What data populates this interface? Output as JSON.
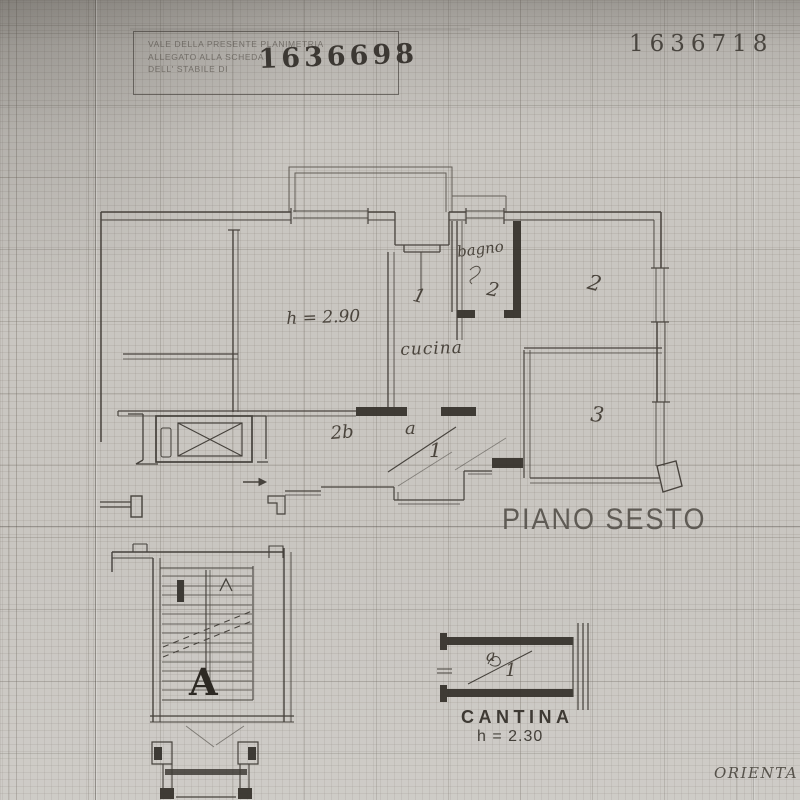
{
  "page": {
    "stamp_box": {
      "line1": "VALE DELLA PRESENTE PLANIMETRIA",
      "line2": "ALLEGATO ALLA SCHEDA",
      "line3": "DELL' STABILE DI",
      "number": "1636698"
    },
    "top_right_number": "1636718",
    "floor_label": "PIANO SESTO",
    "orientation_label": "ORIENTA",
    "cantina": {
      "title": "CANTINA",
      "height_note": "h = 2.30",
      "unit_top": "a",
      "unit_bottom": "1"
    },
    "annotations": {
      "ceiling_height": "h = 2.90",
      "kitchen": "cucina",
      "kitchen_number": "1",
      "bathroom": "bagno",
      "bathroom_number": "2",
      "room_two": "2",
      "room_three": "3",
      "hall": "2b",
      "unit_top": "a",
      "unit_bottom": "1",
      "stair_letter": "A"
    },
    "colors": {
      "paper": "#c9c6c1",
      "ink": "#403b35",
      "stamp_ink": "#3c3833"
    }
  }
}
